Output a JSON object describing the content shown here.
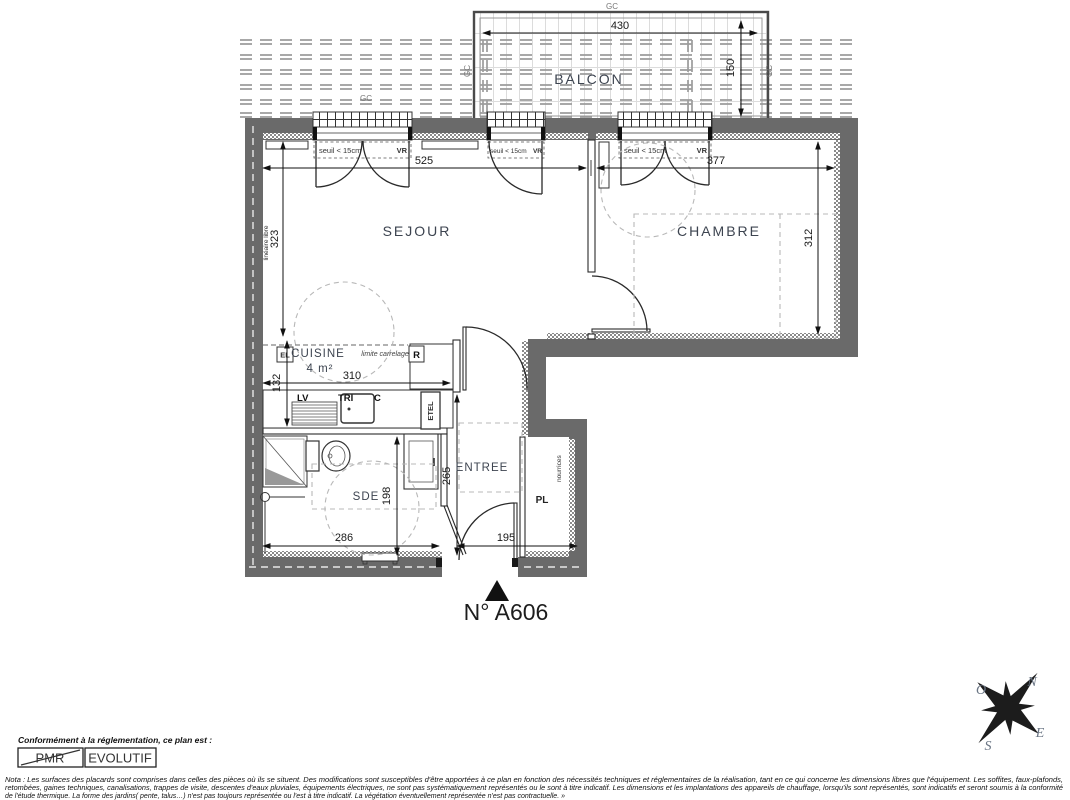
{
  "colors": {
    "wall": "#6a6a6a",
    "dim_text": "#1a1a1a",
    "room_text": "#3d4450",
    "dashed_guide": "#b8b8b8"
  },
  "plan": {
    "unit_label": "N° A606",
    "balcony": {
      "label": "BALCON",
      "width": "430",
      "depth": "150"
    },
    "rooms": {
      "sejour": {
        "label": "SEJOUR",
        "width": "525",
        "height": "323"
      },
      "chambre": {
        "label": "CHAMBRE",
        "width": "377",
        "height": "312"
      },
      "cuisine": {
        "label": "CUISINE",
        "area": "4 m²",
        "width": "310",
        "height": "132"
      },
      "sde": {
        "label": "SDE",
        "width": "286",
        "height": "198"
      },
      "entree": {
        "label": "ENTREE",
        "width": "195",
        "height": "265"
      },
      "placard": {
        "label": "PL"
      }
    },
    "annotations": {
      "gc": "GC",
      "seuil": "seuil < 15cm",
      "vr": "VR",
      "lineaire_libre": "linéaire libre",
      "limite_carrelage": "limite carrelage",
      "el": "EL",
      "r": "R",
      "lv": "LV",
      "tri": "TRI",
      "c": "C",
      "etel": "ETEL",
      "nourrices": "nourrices"
    },
    "compass": {
      "n": "N",
      "o": "O",
      "e": "E",
      "s": "S"
    }
  },
  "footer": {
    "conformity_label": "Conformément à la réglementation, ce plan est :",
    "pmr": "PMR",
    "evolutif": "EVOLUTIF",
    "nota_line1": "Nota : Les surfaces des placards sont comprises dans celles des pièces où ils se situent. Des modifications sont susceptibles d'être apportées à ce plan en fonction des nécessités techniques et réglementaires de la réalisation, tant en ce qui concerne les dimensions libres que l'équipement.  Les soffites, faux-plafonds,",
    "nota_line2": "retombées, gaines techniques, canalisations, trappes de visite, descentes d'eaux pluviales, équipements électriques, ne sont pas systématiquement représentés ou le sont à titre indicatif. Les dimensions et les implantations des appareils de chauffage, lorsqu'ils sont représentés, sont indicatifs et seront soumis à la conformité",
    "nota_line3": "de l'étude thermique. La forme des jardins( pente, talus…) n'est pas toujours représentée ou l'est à titre indicatif. La végétation éventuellement représentée n'est pas contractuelle. »"
  }
}
